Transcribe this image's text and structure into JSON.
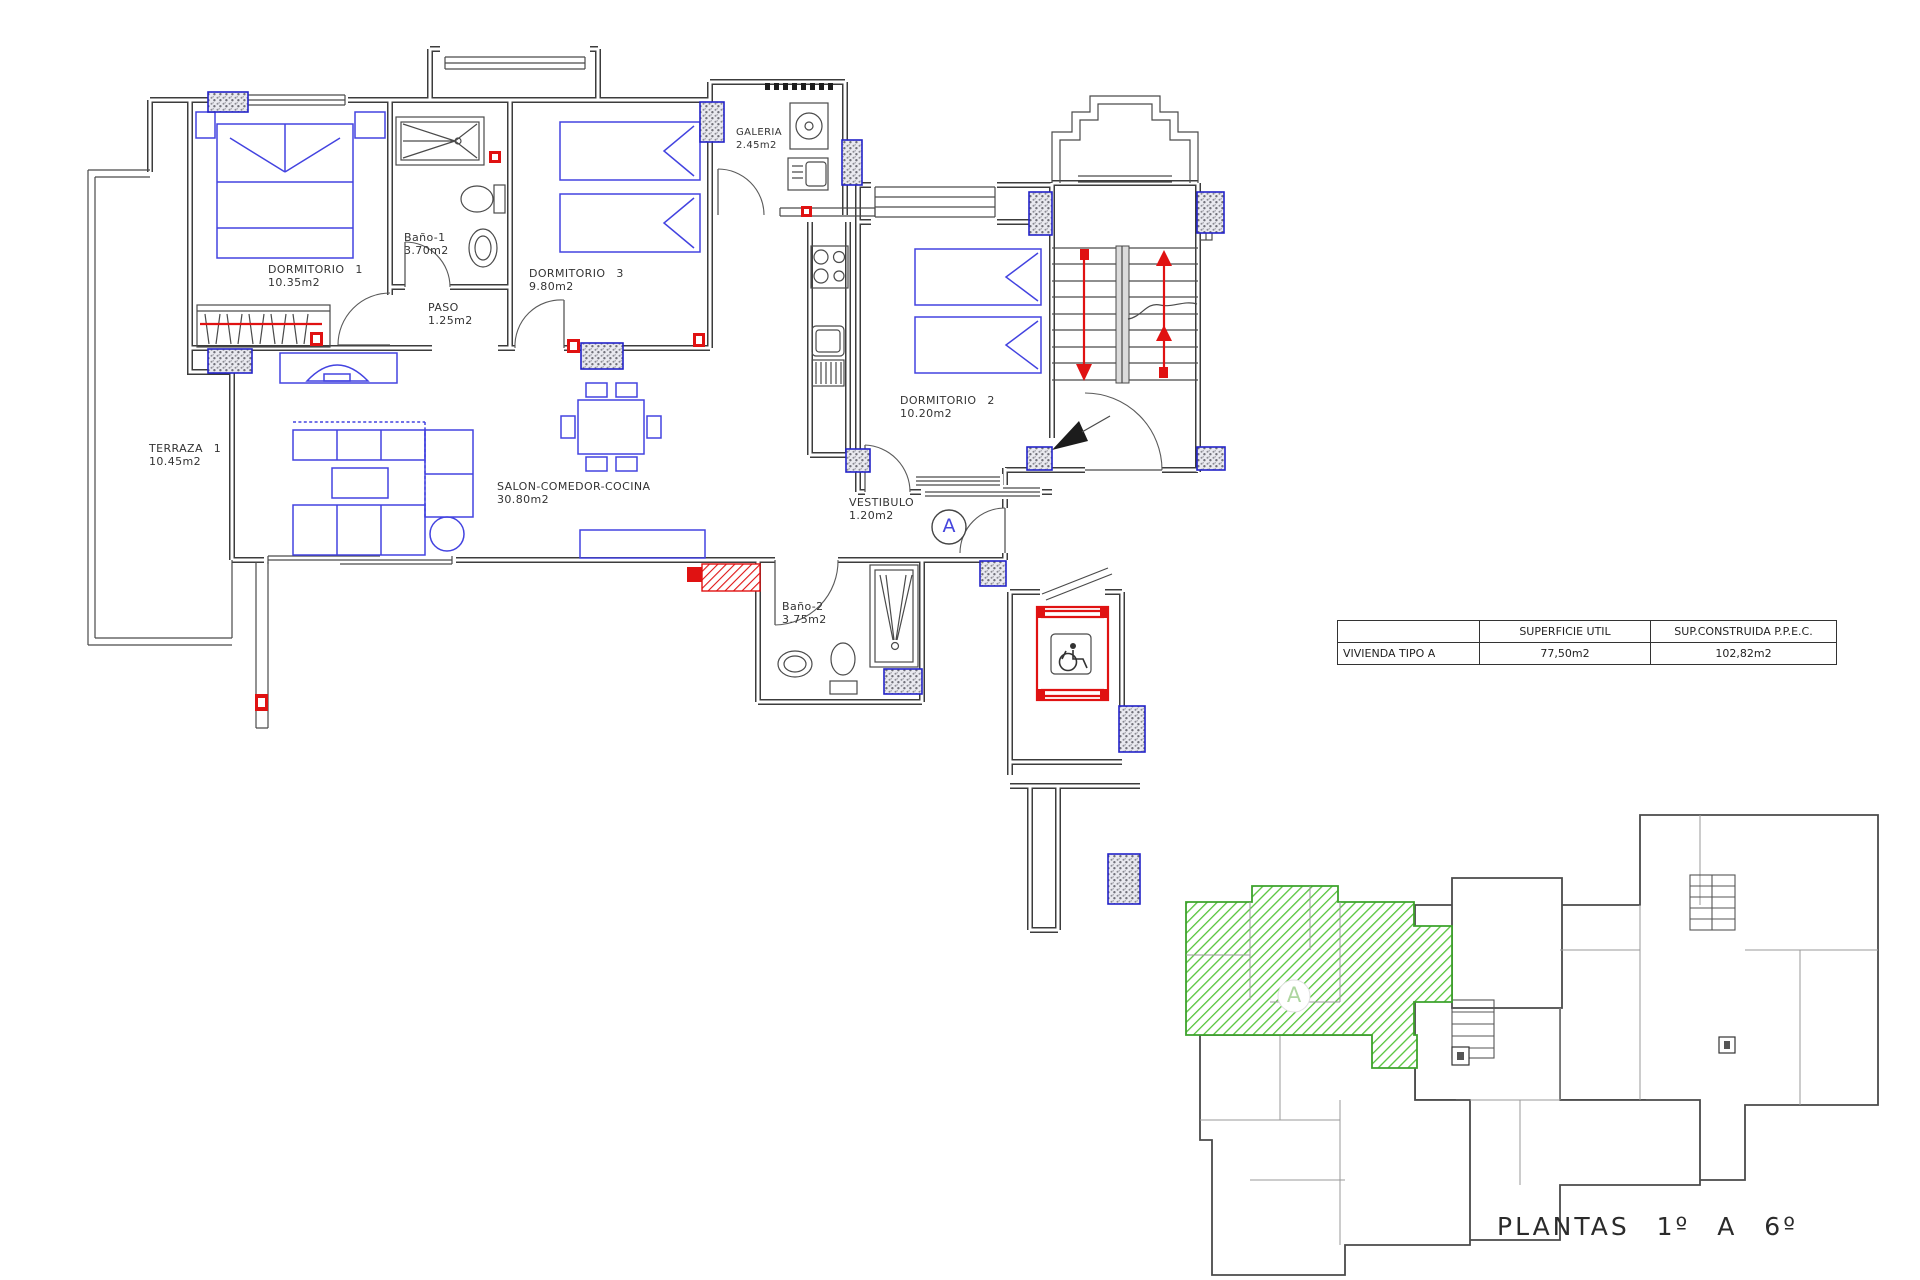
{
  "colors": {
    "wall": "#3c3c3c",
    "furniture": "#4343e0",
    "accent_red": "#e01212",
    "pillar": "#2323c8",
    "unit_green": "#55c43a"
  },
  "main_plan": {
    "unit_label": "A",
    "rooms": [
      {
        "name": "DORMITORIO 1",
        "area": "10.35m2"
      },
      {
        "name": "Baño-1",
        "area": "3.70m2"
      },
      {
        "name": "DORMITORIO 3",
        "area": "9.80m2"
      },
      {
        "name": "PASO",
        "area": "1.25m2"
      },
      {
        "name": "GALERIA",
        "area": "2.45m2"
      },
      {
        "name": "TERRAZA 1",
        "area": "10.45m2"
      },
      {
        "name": "SALON-COMEDOR-COCINA",
        "area": "30.80m2"
      },
      {
        "name": "DORMITORIO 2",
        "area": "10.20m2"
      },
      {
        "name": "VESTIBULO",
        "area": "1.20m2"
      },
      {
        "name": "Baño-2",
        "area": "3.75m2"
      }
    ],
    "icons": [
      "wheelchair-icon",
      "stairs-up-arrow-icon",
      "stairs-down-arrow-icon"
    ]
  },
  "summary_table": {
    "col_headers": [
      "",
      "SUPERFICIE UTIL",
      "SUP.CONSTRUIDA P.P.E.C."
    ],
    "rows": [
      {
        "label": "VIVIENDA TIPO A",
        "superficie_util": "77,50m2",
        "sup_construida": "102,82m2"
      }
    ]
  },
  "overview": {
    "unit_label": "A",
    "caption": "PLANTAS 1º A 6º"
  }
}
